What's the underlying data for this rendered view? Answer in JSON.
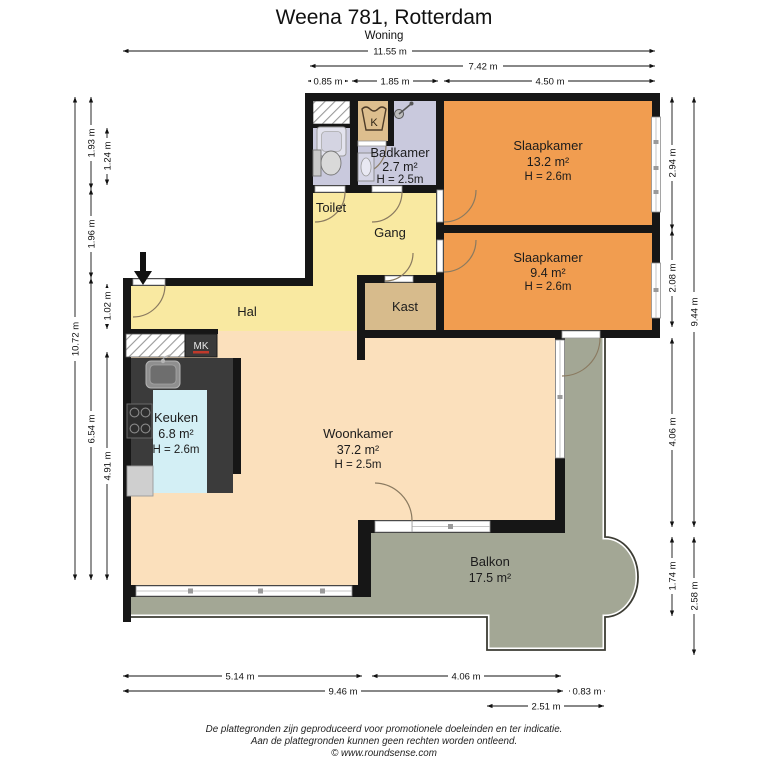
{
  "title": "Weena 781, Rotterdam",
  "subtitle": "Woning",
  "rooms": {
    "toilet": {
      "name": "Toilet"
    },
    "badkamer": {
      "name": "Badkamer",
      "area": "2.7 m²",
      "height": "H = 2.5m"
    },
    "slaapkamer_1": {
      "name": "Slaapkamer",
      "area": "13.2 m²",
      "height": "H = 2.6m"
    },
    "slaapkamer_2": {
      "name": "Slaapkamer",
      "area": "9.4 m²",
      "height": "H = 2.6m"
    },
    "gang": {
      "name": "Gang"
    },
    "kast": {
      "name": "Kast"
    },
    "hal": {
      "name": "Hal"
    },
    "keuken": {
      "name": "Keuken",
      "area": "6.8 m²",
      "height": "H = 2.6m"
    },
    "woonkamer": {
      "name": "Woonkamer",
      "area": "37.2 m²",
      "height": "H = 2.5m"
    },
    "balkon": {
      "name": "Balkon",
      "area": "17.5 m²"
    }
  },
  "fixtures": {
    "washer_symbol": "K",
    "meter_cupboard": "MK"
  },
  "dimensions": {
    "top": {
      "total": "11.55 m",
      "right_section": "7.42 m",
      "shaft": "0.85 m",
      "bathroom": "1.85 m",
      "bedrooms": "4.50 m"
    },
    "left": {
      "total": "10.72 m",
      "top": "1.93 m",
      "middle": "1.96 m",
      "lower": "6.54 m",
      "toilet": "1.24 m",
      "hal": "1.02 m",
      "kitchen": "4.91 m"
    },
    "right": {
      "bedroom1": "2.94 m",
      "bedroom2": "2.08 m",
      "living": "4.06 m",
      "bay": "1.74 m",
      "total": "9.44 m",
      "balcony": "2.58 m"
    },
    "bottom": {
      "left_section": "5.14 m",
      "living_right": "4.06 m",
      "total": "9.46 m",
      "offset": "0.83 m",
      "balcony": "2.51 m"
    }
  },
  "footer": {
    "line1": "De plattegronden zijn geproduceerd voor promotionele doeleinden en ter indicatie.",
    "line2": "Aan de plattegronden kunnen geen rechten worden ontleend.",
    "line3": "© www.roundsense.com"
  },
  "colors": {
    "bedroom": "#F19D50",
    "corridor": "#F9E9A1",
    "living": "#FBE0BC",
    "closet": "#D7BB8C",
    "washer_closet": "#DDBE8E",
    "bathroom": "#C9C9DD",
    "kitchen_floor": "#D3EFF5",
    "balcony": "#A3A795",
    "wall": "#161616",
    "counter": "#3B3B3B"
  }
}
